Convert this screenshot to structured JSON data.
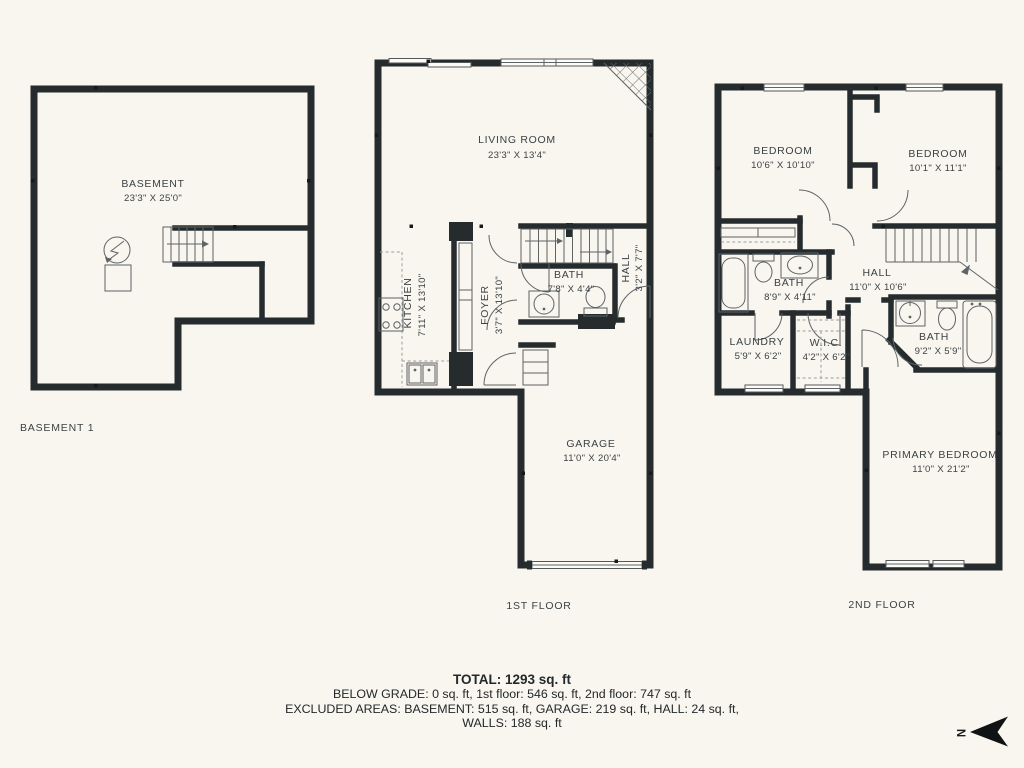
{
  "colors": {
    "background": "#f8f6ef",
    "wall": "#262c2e",
    "line": "#5e6366",
    "text": "#3c4245"
  },
  "plans": {
    "basement": {
      "floor_label": "BASEMENT 1",
      "rooms": {
        "basement": {
          "name": "BASEMENT",
          "dims": "23'3\" X 25'0\""
        }
      }
    },
    "first_floor": {
      "floor_label": "1ST FLOOR",
      "rooms": {
        "living_room": {
          "name": "LIVING ROOM",
          "dims": "23'3\" X 13'4\""
        },
        "kitchen": {
          "name": "KITCHEN",
          "dims": "7'11\" X 13'10\""
        },
        "foyer": {
          "name": "FOYER",
          "dims": "3'7\" X 13'10\""
        },
        "bath": {
          "name": "BATH",
          "dims": "7'8\" X 4'4\""
        },
        "hall": {
          "name": "HALL",
          "dims": "3'2\" X 7'7\""
        },
        "garage": {
          "name": "GARAGE",
          "dims": "11'0\" X 20'4\""
        }
      }
    },
    "second_floor": {
      "floor_label": "2ND FLOOR",
      "rooms": {
        "bedroom_left": {
          "name": "BEDROOM",
          "dims": "10'6\" X 10'10\""
        },
        "bedroom_right": {
          "name": "BEDROOM",
          "dims": "10'1\" X 11'1\""
        },
        "bath_left": {
          "name": "BATH",
          "dims": "8'9\" X 4'11\""
        },
        "hall": {
          "name": "HALL",
          "dims": "11'0\" X 10'6\""
        },
        "laundry": {
          "name": "LAUNDRY",
          "dims": "5'9\" X 6'2\""
        },
        "wic": {
          "name": "W.I.C.",
          "dims": "4'2\" X 6'2\""
        },
        "bath_right": {
          "name": "BATH",
          "dims": "9'2\" X 5'9\""
        },
        "primary_bedroom": {
          "name": "PRIMARY BEDROOM",
          "dims": "11'0\" X 21'2\""
        }
      }
    }
  },
  "summary": {
    "total": "TOTAL: 1293 sq. ft",
    "below_grade": "BELOW GRADE: 0 sq. ft, 1st floor: 546 sq. ft, 2nd floor: 747 sq. ft",
    "excluded": "EXCLUDED AREAS: BASEMENT: 515 sq. ft, GARAGE: 219 sq. ft, HALL: 24 sq. ft,",
    "walls": "WALLS: 188 sq. ft"
  },
  "compass": {
    "label": "N"
  }
}
